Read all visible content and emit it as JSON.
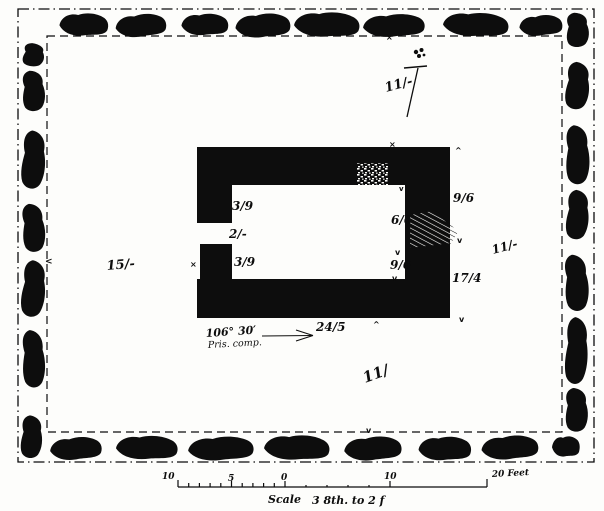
{
  "page": {
    "title": "Survey plan of walled enclosure with stone boundary",
    "paper_color": "#fdfdfb",
    "ink_color": "#0d0d0d"
  },
  "north_indicator": {
    "label": "11/-"
  },
  "bearing": {
    "angle": "106° 30′",
    "method": "Pris. comp."
  },
  "measurements": {
    "left_area": "15/-",
    "right_area": "11/-",
    "lower_area": "11/",
    "outer_right_upper": "9/6",
    "outer_right_lower": "17/4",
    "inner_left_upper": "3/9",
    "entrance": "2/-",
    "inner_left_lower": "3/9",
    "inner_right_upper": "6/6",
    "inner_right_lower": "9/6",
    "bottom_wall": "24/5"
  },
  "scale_bar": {
    "left_label_10": "10",
    "left_label_5": "5",
    "zero_label": "0",
    "right_label_10": "10",
    "end_label": "20 Feet",
    "caption_word": "Scale",
    "caption_ratio": "3 8th. to 2 f"
  },
  "marks": {
    "cross": "×",
    "caret_up": "^",
    "caret_down": "v",
    "less_than": "<"
  }
}
